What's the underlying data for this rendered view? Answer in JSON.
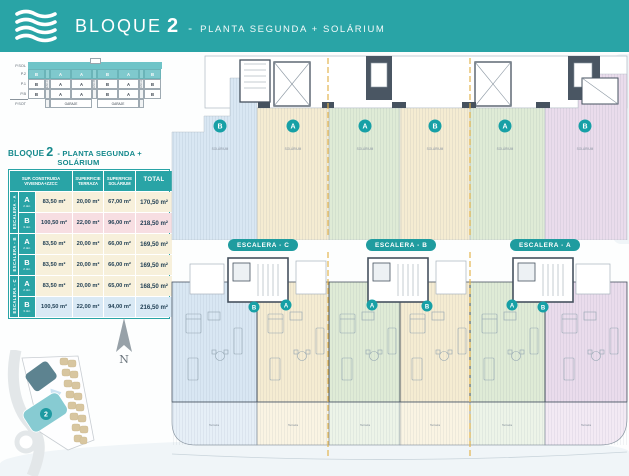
{
  "colors": {
    "teal": "#29A4A6",
    "teal_dark": "#15898C",
    "wall": "#46525F",
    "section_line": "#E3B44F",
    "apt_cream": "#F5ECD2",
    "apt_green": "#DFEBD6",
    "apt_blue": "#D9E7F3",
    "apt_pink": "#EADCEC",
    "row_cream": "#F7F0DB",
    "row_pink": "#F7DEE2",
    "row_blue": "#D9E9F5"
  },
  "header": {
    "logo": "wave-logo",
    "title_block": "BLOQUE",
    "title_number": "2",
    "separator": "-",
    "subtitle": "PLANTA SEGUNDA + SOLÁRIUM"
  },
  "section_diagram": {
    "floor_labels": [
      "P.SOL",
      "P.2",
      "P.1",
      "P.B",
      "P.SOT"
    ],
    "rows": [
      {
        "cells": [
          "B",
          "A",
          "A",
          "B",
          "A",
          "B"
        ]
      },
      {
        "cells": [
          "B",
          "A",
          "A",
          "B",
          "A",
          "B"
        ]
      },
      {
        "cells": [
          "B",
          "A",
          "A",
          "B",
          "A",
          "B"
        ]
      }
    ],
    "stair_labels": [
      "ESC.C",
      "ESC.B",
      "ESC.A"
    ],
    "garage_labels": [
      "GARAJE",
      "GARAJE"
    ]
  },
  "table": {
    "title_block": "BLOQUE",
    "title_number": "2",
    "title_rest": "- PLANTA SEGUNDA + SOLÁRIUM",
    "headers": {
      "built": "SUP. CONSTRUIDA VIVIENDA+ZZCC",
      "terrace": "SUPERFICIE TERRAZA",
      "solarium": "SUPERFICIE SOLÁRIUM",
      "total": "TOTAL"
    },
    "groups": [
      {
        "label": "ESCALERA - A",
        "rows": [
          {
            "letter": "A",
            "dorms": "2 dor.",
            "built": "83,50 m²",
            "terrace": "20,00 m²",
            "solarium": "67,00 m²",
            "total": "170,50 m²"
          },
          {
            "letter": "B",
            "dorms": "3 dor.",
            "built": "100,50 m²",
            "terrace": "22,00 m²",
            "solarium": "96,00 m²",
            "total": "218,50 m²"
          }
        ]
      },
      {
        "label": "ESCALERA - B",
        "rows": [
          {
            "letter": "A",
            "dorms": "2 dor.",
            "built": "83,50 m²",
            "terrace": "20,00 m²",
            "solarium": "66,00 m²",
            "total": "169,50 m²"
          },
          {
            "letter": "B",
            "dorms": "2 dor.",
            "built": "83,50 m²",
            "terrace": "20,00 m²",
            "solarium": "66,00 m²",
            "total": "169,50 m²"
          }
        ]
      },
      {
        "label": "ESCALERA - C",
        "rows": [
          {
            "letter": "A",
            "dorms": "2 dor.",
            "built": "83,50 m²",
            "terrace": "20,00 m²",
            "solarium": "65,00 m²",
            "total": "168,50 m²"
          },
          {
            "letter": "B",
            "dorms": "3 dor.",
            "built": "100,50 m²",
            "terrace": "22,00 m²",
            "solarium": "94,00 m²",
            "total": "216,50 m²"
          }
        ]
      }
    ]
  },
  "plans": {
    "solarium": {
      "area_label": "SOLÁRIUM",
      "units": [
        {
          "letter": "B"
        },
        {
          "letter": "A"
        },
        {
          "letter": "A"
        },
        {
          "letter": "B"
        },
        {
          "letter": "A"
        },
        {
          "letter": "B"
        }
      ]
    },
    "floor": {
      "pills": [
        "ESCALERA - C",
        "ESCALERA - B",
        "ESCALERA - A"
      ],
      "terrace_label": "Terraza",
      "units": [
        {
          "letter": "B"
        },
        {
          "letter": "A"
        },
        {
          "letter": "A"
        },
        {
          "letter": "B"
        },
        {
          "letter": "A"
        },
        {
          "letter": "B"
        }
      ]
    }
  },
  "site_map": {
    "north": "N",
    "block_badge": "2"
  }
}
